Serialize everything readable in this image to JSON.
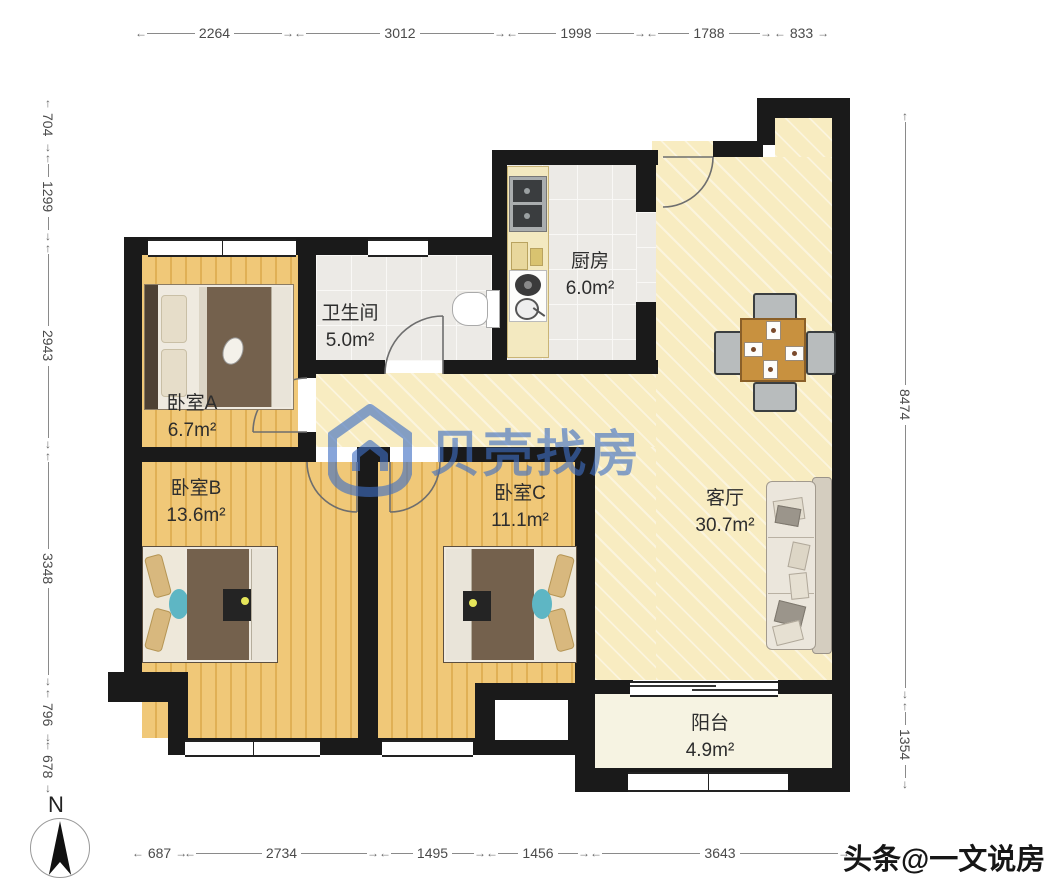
{
  "dimensions": {
    "top": [
      "2264",
      "3012",
      "1998",
      "1788",
      "833"
    ],
    "left": [
      "704",
      "1299",
      "2943",
      "3348",
      "796",
      "678"
    ],
    "right": [
      "8474",
      "1354"
    ],
    "bottom": [
      "687",
      "2734",
      "1495",
      "1456",
      "3643"
    ]
  },
  "rooms": {
    "bedroom_a": {
      "name": "卧室A",
      "area": "6.7m²"
    },
    "bathroom": {
      "name": "卫生间",
      "area": "5.0m²"
    },
    "kitchen": {
      "name": "厨房",
      "area": "6.0m²"
    },
    "living_room": {
      "name": "客厅",
      "area": "30.7m²"
    },
    "bedroom_b": {
      "name": "卧室B",
      "area": "13.6m²"
    },
    "bedroom_c": {
      "name": "卧室C",
      "area": "11.1m²"
    },
    "balcony": {
      "name": "阳台",
      "area": "4.9m²"
    }
  },
  "watermark": {
    "brand": "贝壳找房",
    "color": "#3E6FC4"
  },
  "credit": {
    "text": "头条@一文说房"
  },
  "compass": {
    "label": "N"
  },
  "palette": {
    "wall": "#1A1A1A",
    "wood_floor": "#EEC26E",
    "marble_floor": "#F8ECC1",
    "tile_floor": "#ECEAE6",
    "balcony_floor": "#F6F3E2",
    "dimension_text": "#4A4A4A"
  }
}
